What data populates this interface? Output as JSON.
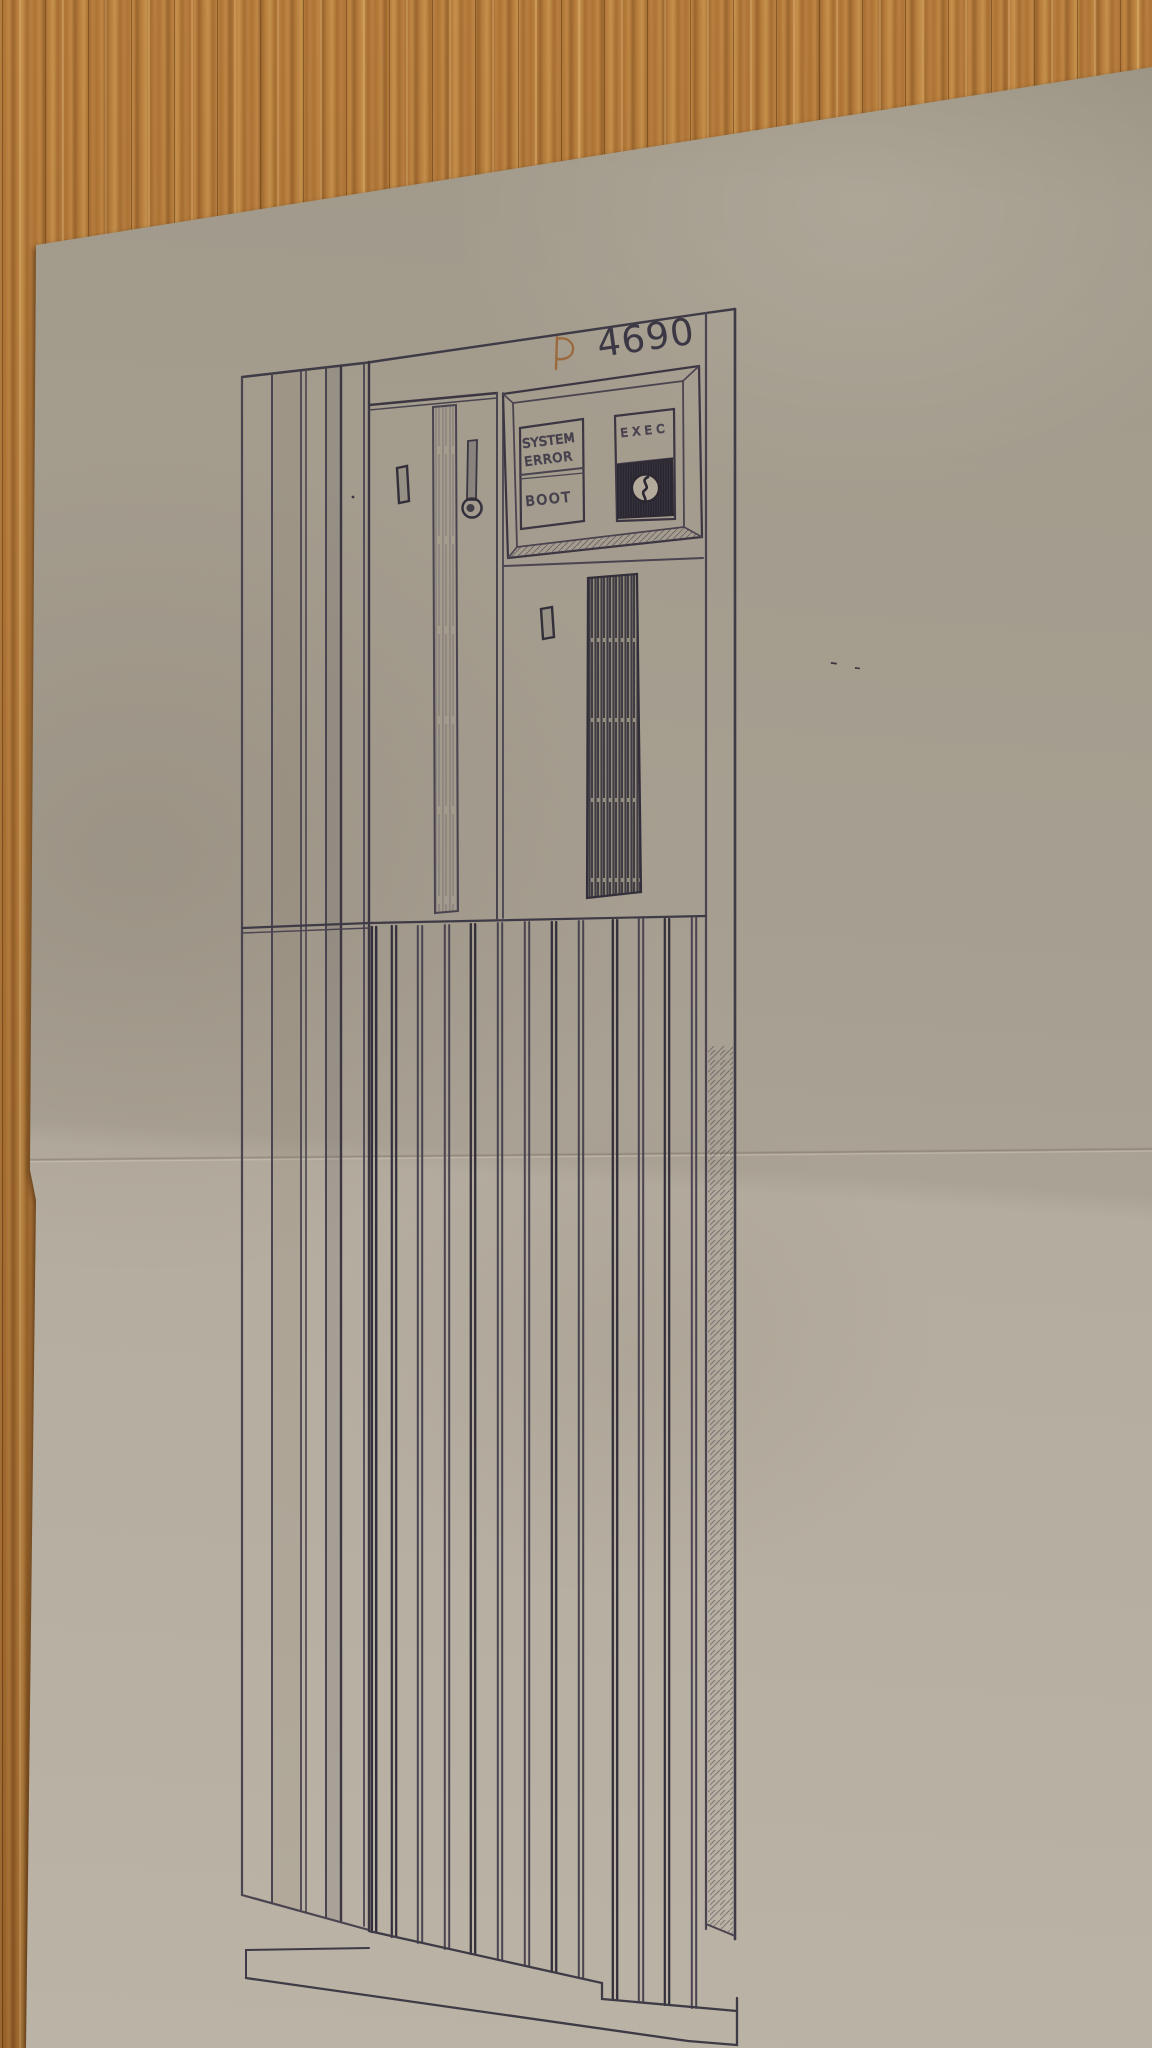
{
  "photo_subject": {
    "model_number": "4690",
    "brand_glyph": "D"
  },
  "control_panel": {
    "status_line1": "SYSTEM",
    "status_line2": "ERROR",
    "boot_label": "BOOT",
    "exec_label": "EXEC"
  },
  "colors": {
    "wood_base": "#a9712f",
    "wood_dark": "#7c4c1d",
    "wood_light": "#c08a46",
    "paper_upper": "#a59d8e",
    "paper_lower": "#b6aea0",
    "pencil": "#4a4450",
    "pencil_dark": "#332f3a",
    "logo_accent": "#9b6a3e"
  }
}
